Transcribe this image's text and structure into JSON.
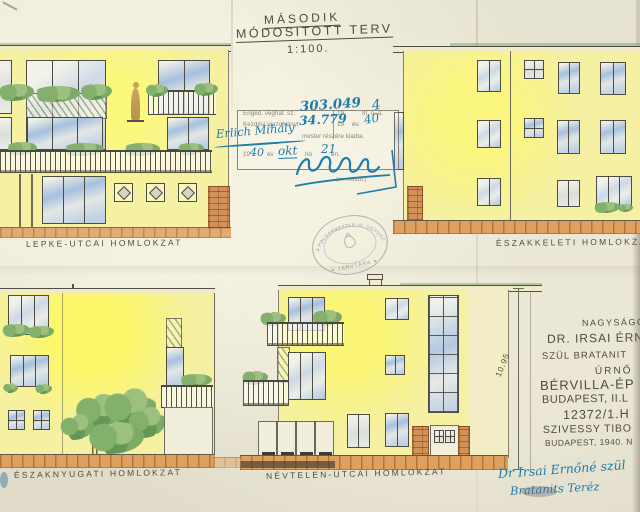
{
  "title": {
    "line1": "MÁSODIK",
    "line2": "MÓDOSITOTT TERV",
    "scale": "1:100."
  },
  "labels": {
    "lepke": "LEPKE-UTCAI HOMLOKZAT",
    "eszakkeleti": "ÉSZAKKELETI HOMLOKZAT",
    "eszaknyugati": "ÉSZAKNYUGATI HOMLOKZAT",
    "nevtelen": "NÉVTELEN-UTCAI HOMLOKZAT"
  },
  "stamp": {
    "y19": "19",
    "row1_label": "Enged. véghat. sz.",
    "row1_no": "303.049",
    "row1_yhand": "4",
    "row1_right": "III. ö. a.",
    "row2_label": "Kezdési igazolványt",
    "row2_no": "34.779",
    "row2_yhand": "40",
    "row2_right": "év.",
    "row3_hand": "Erlich Mihály",
    "row3_printed": "mester részére kiadta.",
    "row4_yhand": "40",
    "row4_ev": "év",
    "row4_month": "okt",
    "row4_ho": "hó",
    "row4_day": "21",
    "row4_en": "én.",
    "small_print": "(im. műszh.)"
  },
  "seal": {
    "top_text": "A POLGÁRMESTER III. ÜGYOSZTÁLY",
    "bottom_text": "✶ TERVTÁRA ✶"
  },
  "dimension": {
    "value": "10.95"
  },
  "client": {
    "lines": [
      "NAGYSÁGOS",
      "DR. IRSAI ÉRN",
      "SZÜL BRATANIT",
      "ÚRNŐ",
      "BÉRVILLA-ÉP",
      "BUDAPEST, II.L",
      "12372/1.H",
      "SZIVESSY TIBO",
      "BUDAPEST, 1940. N"
    ]
  },
  "approval": {
    "line1": "Dr Irsai Ernőné  szül",
    "line2": "Bratanits Teréz"
  }
}
